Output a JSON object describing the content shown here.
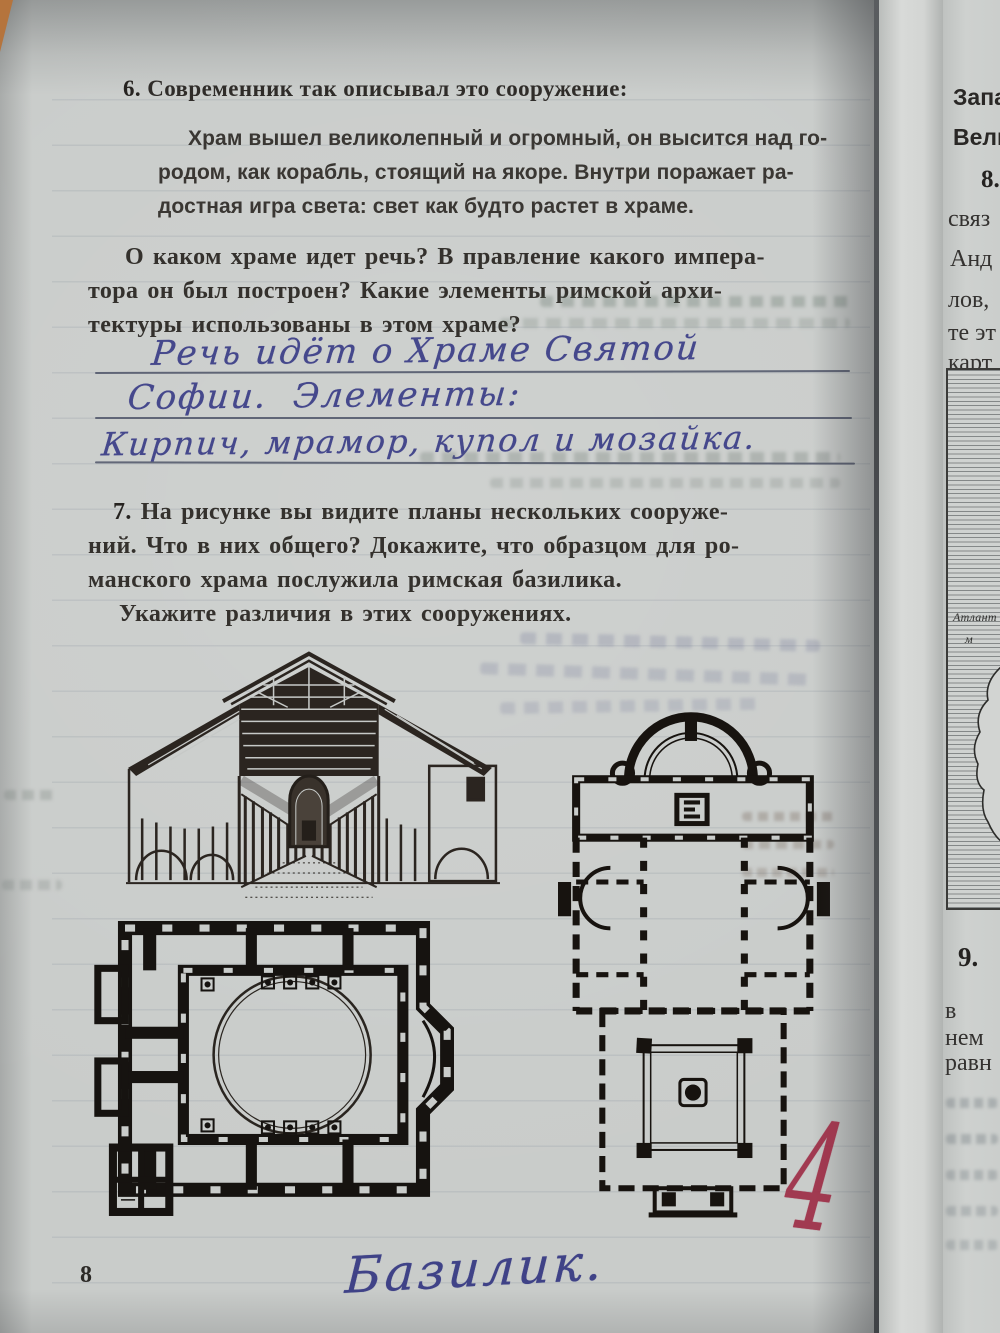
{
  "page": {
    "number": "8",
    "q6": {
      "num": "6.",
      "heading": "Современник так описывал это сооружение:",
      "quote": [
        "Храм вышел великолепный и огромный, он высится над го-",
        "родом, как корабль, стоящий на якоре. Внутри поражает ра-",
        "достная игра света: свет как будто растет в храме."
      ],
      "question": [
        "О каком храме идет речь? В правление какого импера-",
        "тора он был построен? Какие элементы римской архи-",
        "тектуры использованы в этом храме?"
      ],
      "answer": [
        "Речь идёт о Храме Святой",
        "Софии.  Элементы:",
        "Кирпич, мрамор, купол и мозайка."
      ]
    },
    "q7": {
      "num": "7.",
      "text": [
        "На рисунке вы видите планы нескольких сооруже-",
        "ний. Что в них общего? Докажите, что образцом для ро-",
        "манского храма послужила римская базилика.",
        "Укажите различия в этих сооружениях."
      ]
    },
    "note": "Базилик.",
    "grade": "4"
  },
  "figures": {
    "interior": "basilica-interior-cutaway-drawing",
    "domed_plan": "domed-church-floor-plan",
    "basilica_plan": "roman-basilica-floor-plan"
  },
  "next_page": {
    "top": [
      "Запа",
      "Вели"
    ],
    "item8": {
      "num": "8.",
      "lines": [
        "связ",
        "Анд",
        "лов,",
        "те эт",
        "карт"
      ]
    },
    "map": {
      "labels": [
        "Атлант",
        "м"
      ]
    },
    "item9": {
      "num": "9.",
      "lines": [
        "в нем",
        "равн"
      ]
    }
  },
  "colors": {
    "paper": "#c9ccca",
    "ink": "#2f2c29",
    "pen_blue": "#45488c",
    "grade_red": "#9c2741"
  }
}
